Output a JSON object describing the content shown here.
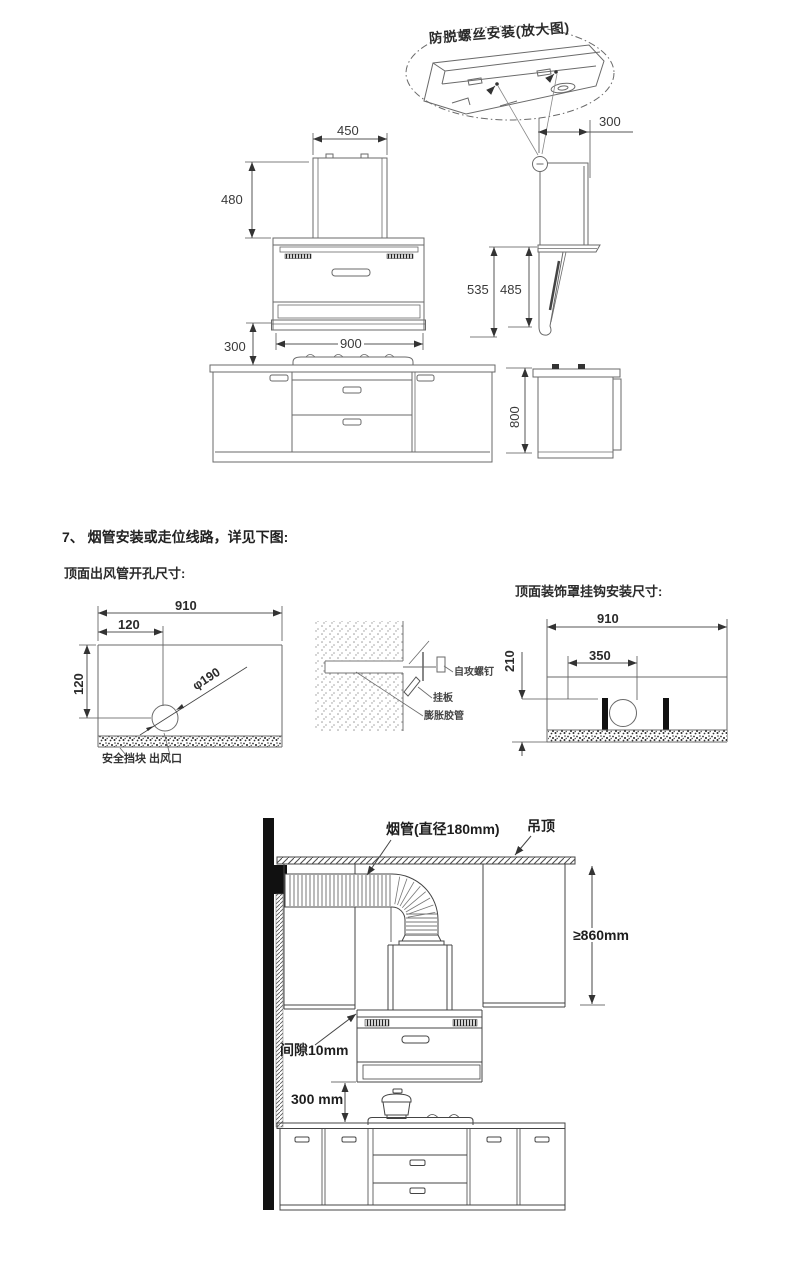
{
  "hood_views": {
    "callout_title": "防脱螺丝安装(放大图)",
    "front": {
      "chimney_width": "450",
      "chimney_height": "480",
      "clearance": "300",
      "body_width": "900"
    },
    "side": {
      "chimney_depth": "300",
      "height_outer": "535",
      "height_inner": "485"
    },
    "base_cabinet": {
      "height": "800"
    }
  },
  "step7": {
    "heading": "7、 烟管安装或走位线路，详见下图:",
    "vent_hole": {
      "title": "顶面出风管开孔尺寸:",
      "width": "910",
      "offset_x": "120",
      "offset_y": "120",
      "hole_dia": "φ190",
      "bottom_labels": "安全挡块  出风口"
    },
    "wall_mount": {
      "screw": "自攻螺钉",
      "plate": "挂板",
      "anchor": "膨胀胶管"
    },
    "hook_mount": {
      "title": "顶面装饰罩挂钩安装尺寸:",
      "width": "910",
      "hook_span": "350",
      "height": "210"
    }
  },
  "install": {
    "duct_label": "烟管(直径180mm)",
    "ceiling_label": "吊顶",
    "min_height": "≥860mm",
    "gap_label": "间隙10mm",
    "hood_clearance": "300 mm"
  }
}
